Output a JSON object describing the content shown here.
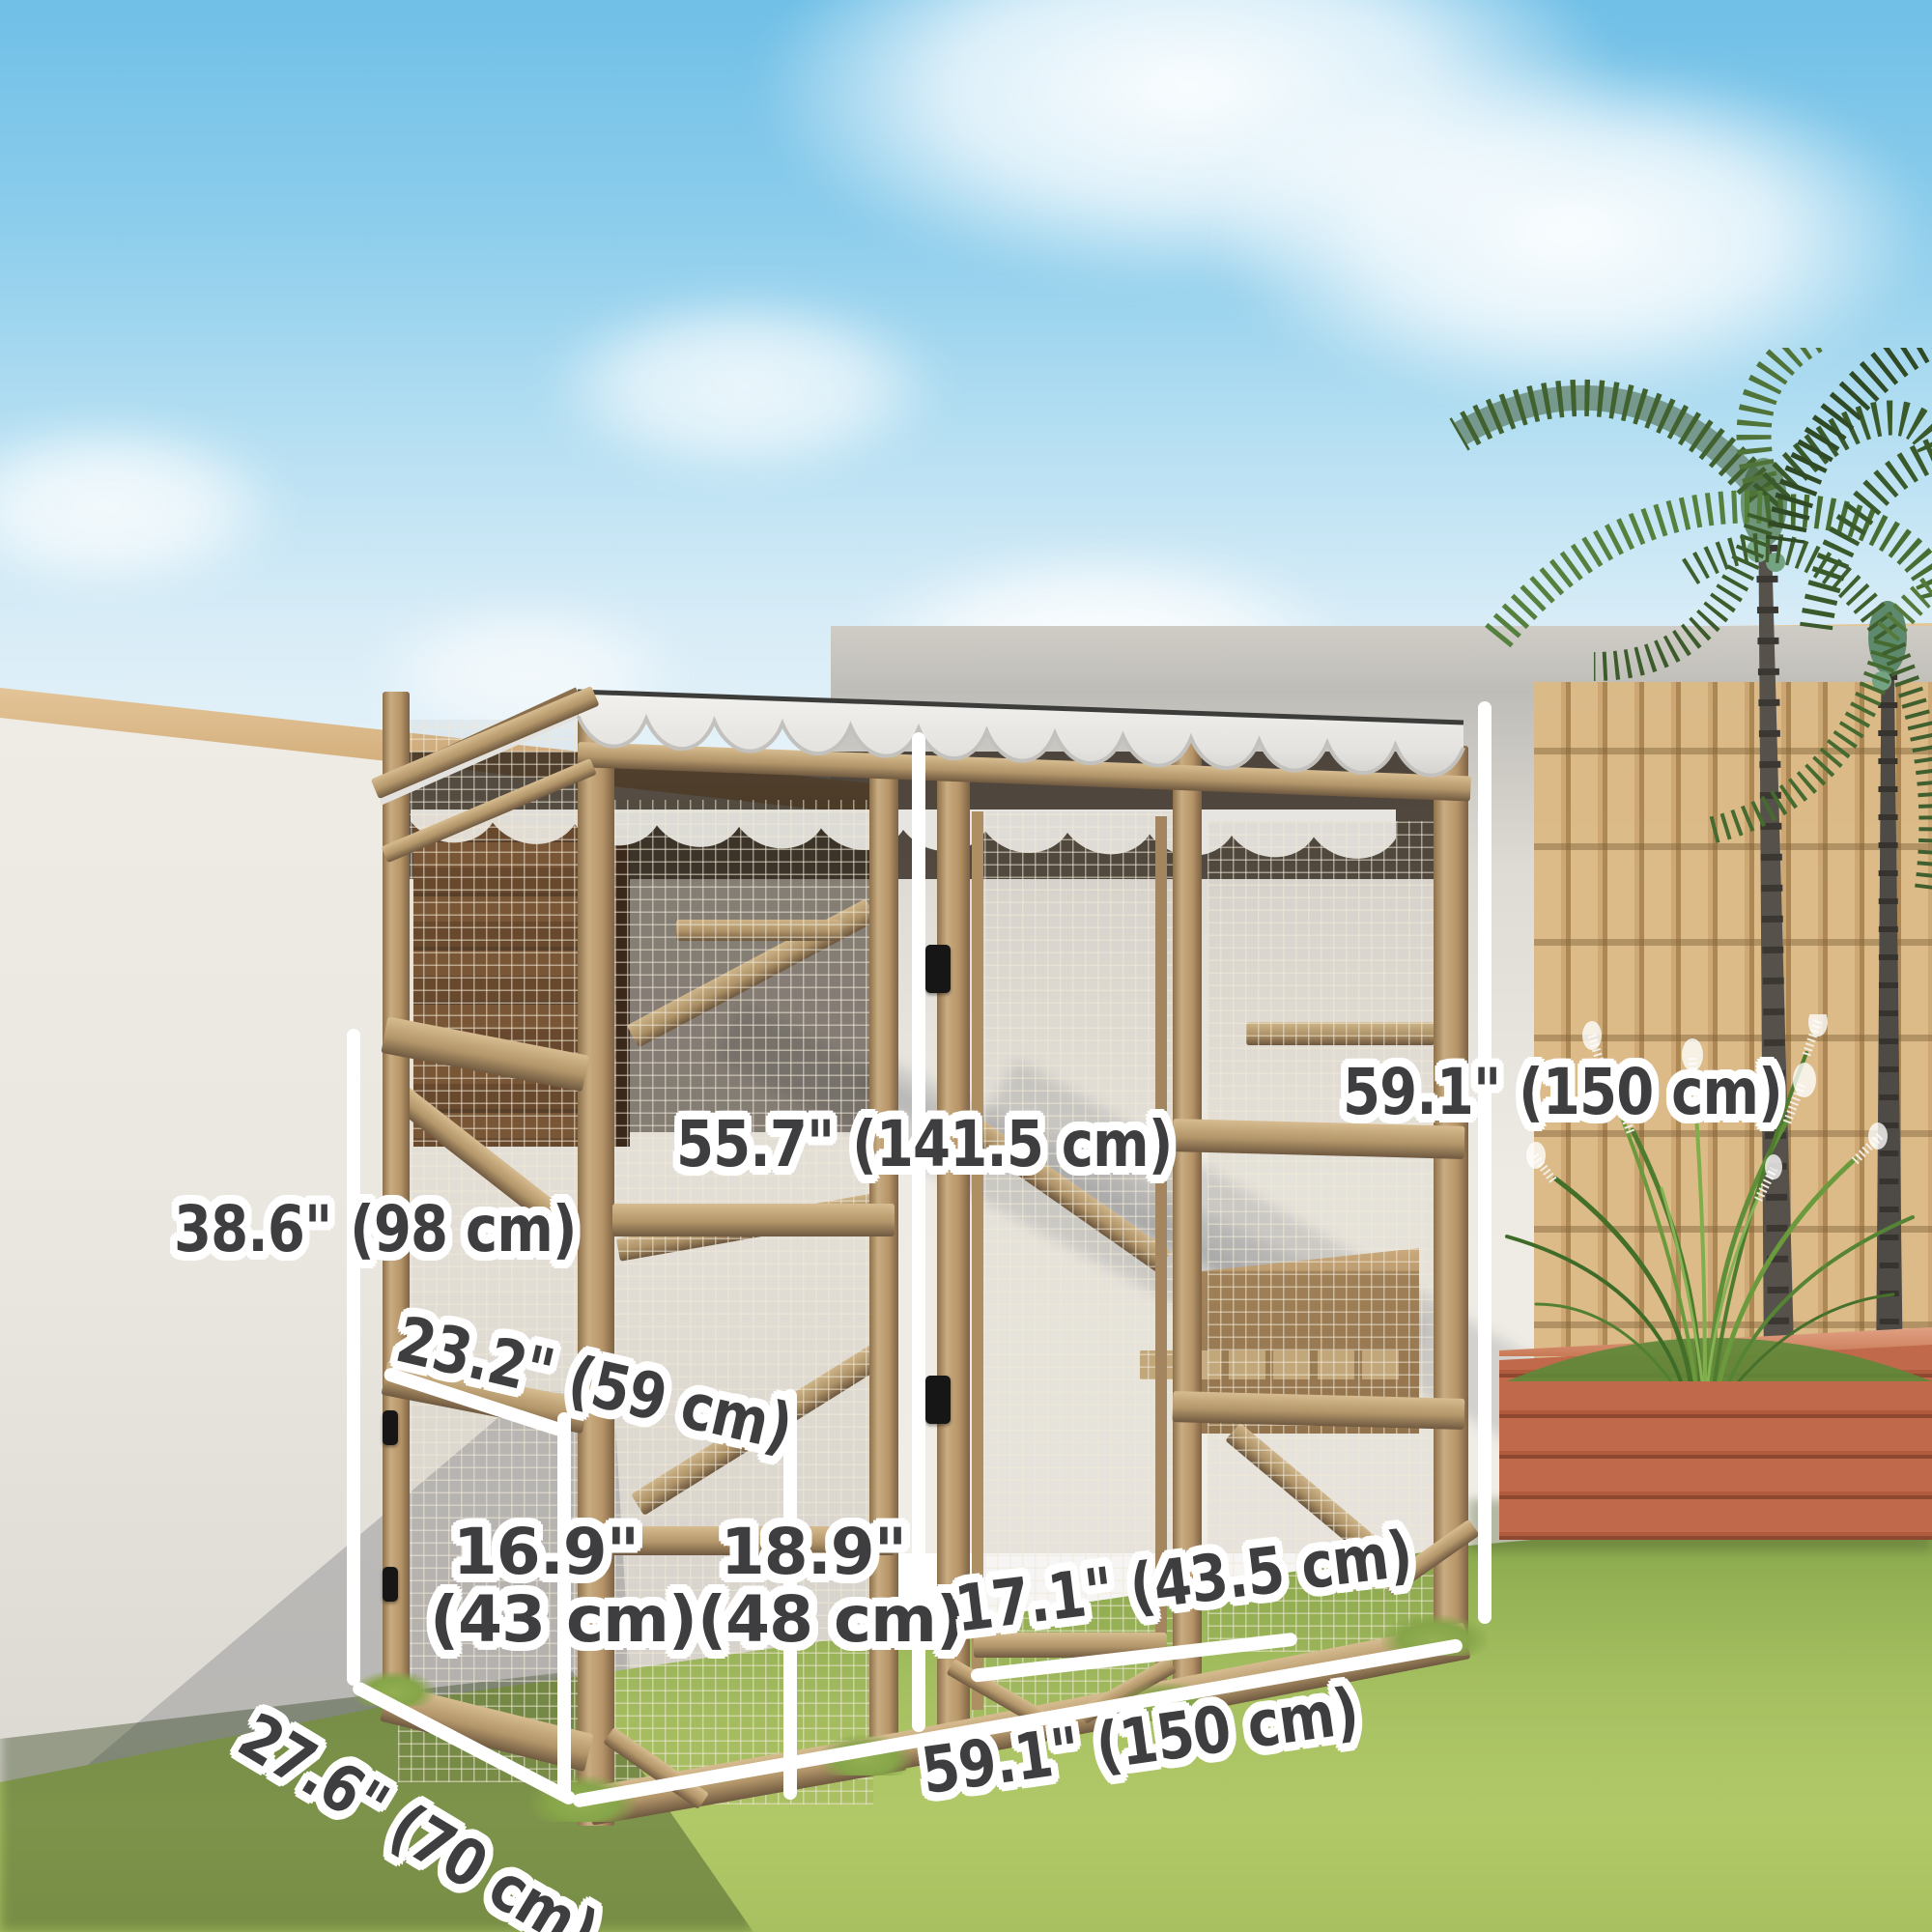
{
  "annotations": {
    "height_total": {
      "text": "59.1\" (150 cm)"
    },
    "height_inner": {
      "text": "55.7\" (141.5 cm)"
    },
    "height_left": {
      "text": "38.6\" (98 cm)"
    },
    "shelf_length": {
      "text": "23.2\" (59 cm)"
    },
    "left_door_width": {
      "line1": "16.9\"",
      "line2": "(43 cm)"
    },
    "center_panel_width": {
      "line1": "18.9\"",
      "line2": "(48 cm)"
    },
    "right_door_width": {
      "text": "17.1\" (43.5 cm)"
    },
    "depth": {
      "text": "27.6\" (70 cm)"
    },
    "width_total": {
      "text": "59.1\" (150 cm)"
    }
  },
  "colors": {
    "sky_top": "#6fbfe7",
    "sky_horizon": "#e8f3f9",
    "wall": "#eae7e0",
    "wall_cap_wood": "#d5b07e",
    "grass": "#a7c162",
    "frame_wood": "#b69468",
    "roof_white": "#efeeea",
    "mesh_wire": "#f0e9d7",
    "cat_house_brown": "#6b4a2e",
    "planter_terracotta": "#c06a4b",
    "bamboo": "#dcba86",
    "palm_green": "#4c7238",
    "label_text": "#3e3e40",
    "label_outline": "#ffffff",
    "dimension_line": "#474747"
  }
}
